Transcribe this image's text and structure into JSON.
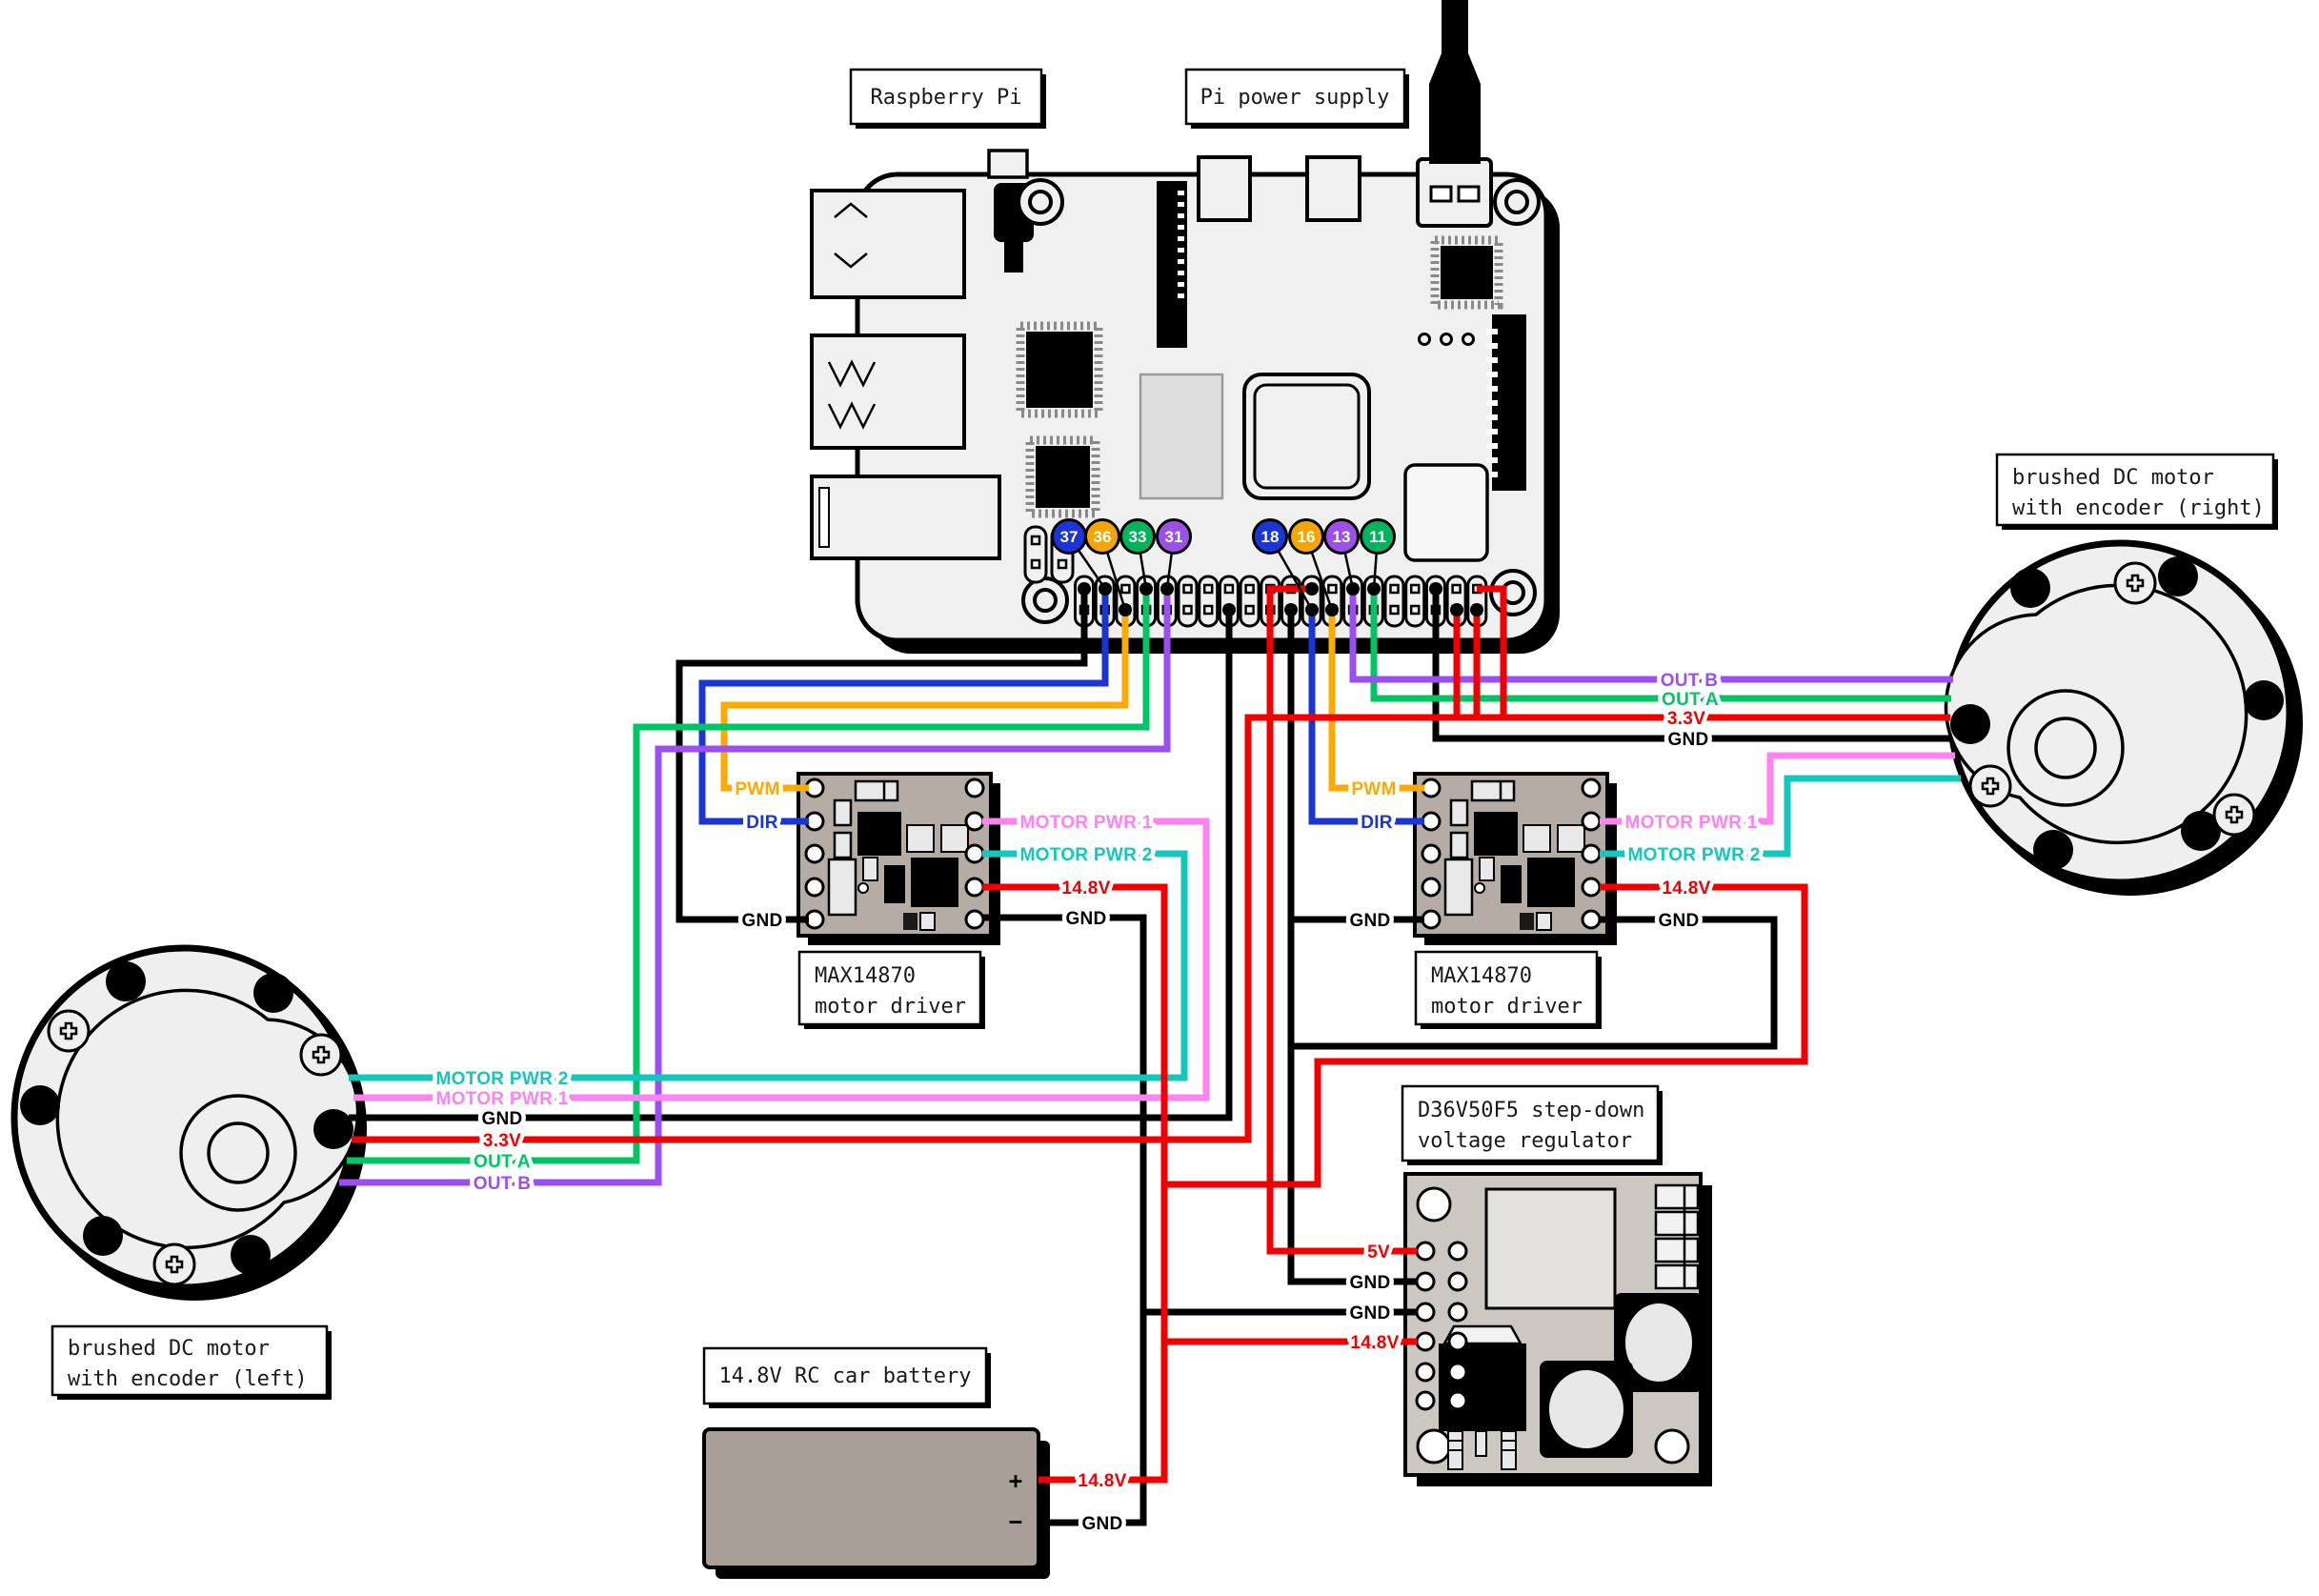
{
  "boxes": {
    "raspberry_pi": "Raspberry Pi",
    "pi_power_supply": "Pi power supply",
    "motor_driver_line1": "MAX14870",
    "motor_driver_line2": "motor driver",
    "regulator_line1": "D36V50F5 step-down",
    "regulator_line2": "voltage regulator",
    "battery": "14.8V RC car battery",
    "motor_left_line1": "brushed DC motor",
    "motor_left_line2": "with encoder (left)",
    "motor_right_line1": "brushed DC motor",
    "motor_right_line2": "with encoder (right)"
  },
  "wire_labels": {
    "pwm": "PWM",
    "dir": "DIR",
    "gnd": "GND",
    "motor_pwr_1": "MOTOR PWR 1",
    "motor_pwr_2": "MOTOR PWR 2",
    "v_14_8": "14.8V",
    "v_3_3": "3.3V",
    "v_5": "5V",
    "out_a": "OUT A",
    "out_b": "OUT B",
    "plus": "+",
    "minus": "−"
  },
  "gpio_pins": [
    {
      "number": "37",
      "color": "#1b35d6"
    },
    {
      "number": "36",
      "color": "#f5a500"
    },
    {
      "number": "33",
      "color": "#00b35c"
    },
    {
      "number": "31",
      "color": "#9b51e8"
    },
    {
      "number": "18",
      "color": "#1b35d6"
    },
    {
      "number": "16",
      "color": "#f5a500"
    },
    {
      "number": "13",
      "color": "#9b51e8"
    },
    {
      "number": "11",
      "color": "#00b35c"
    }
  ],
  "colors": {
    "black": "#000000",
    "red": "#f20000",
    "orange": "#ffaa00",
    "blue": "#1a35d3",
    "green": "#00c566",
    "purple": "#9b4ff0",
    "pink": "#ff82f1",
    "cyan": "#14c7bc",
    "pi_board": "#f0f0f0",
    "driver_pcb": "#b5ada5",
    "regulator_pcb": "#ccc7c1",
    "battery_body": "#a89f97"
  },
  "connections": [
    {
      "signal": "PWM",
      "from": "Raspberry Pi pin 36",
      "to": "MAX14870 motor driver (left) PWM",
      "color": "orange"
    },
    {
      "signal": "DIR",
      "from": "Raspberry Pi pin 37",
      "to": "MAX14870 motor driver (left) DIR",
      "color": "blue"
    },
    {
      "signal": "GND",
      "from": "Raspberry Pi GND",
      "to": "MAX14870 motor driver (left) GND",
      "color": "black"
    },
    {
      "signal": "MOTOR PWR 1",
      "from": "MAX14870 (left)",
      "to": "brushed DC motor (left)",
      "color": "pink"
    },
    {
      "signal": "MOTOR PWR 2",
      "from": "MAX14870 (left)",
      "to": "brushed DC motor (left)",
      "color": "cyan"
    },
    {
      "signal": "OUT A",
      "from": "Raspberry Pi pin 33",
      "to": "left motor encoder OUT A",
      "color": "green"
    },
    {
      "signal": "OUT B",
      "from": "Raspberry Pi pin 31",
      "to": "left motor encoder OUT B",
      "color": "purple"
    },
    {
      "signal": "3.3V",
      "from": "Raspberry Pi 3.3V",
      "to": "left and right motor encoders",
      "color": "red"
    },
    {
      "signal": "GND",
      "from": "Raspberry Pi GND",
      "to": "left motor encoder GND",
      "color": "black"
    },
    {
      "signal": "PWM",
      "from": "Raspberry Pi pin 16",
      "to": "MAX14870 motor driver (right) PWM",
      "color": "orange"
    },
    {
      "signal": "DIR",
      "from": "Raspberry Pi pin 18",
      "to": "MAX14870 motor driver (right) DIR",
      "color": "blue"
    },
    {
      "signal": "OUT B",
      "from": "Raspberry Pi pin 13",
      "to": "right motor encoder OUT B",
      "color": "purple"
    },
    {
      "signal": "OUT A",
      "from": "Raspberry Pi pin 11",
      "to": "right motor encoder OUT A",
      "color": "green"
    },
    {
      "signal": "GND",
      "from": "Raspberry Pi GND",
      "to": "right motor encoder GND",
      "color": "black"
    },
    {
      "signal": "MOTOR PWR 1",
      "from": "MAX14870 (right)",
      "to": "brushed DC motor (right)",
      "color": "pink"
    },
    {
      "signal": "MOTOR PWR 2",
      "from": "MAX14870 (right)",
      "to": "brushed DC motor (right)",
      "color": "cyan"
    },
    {
      "signal": "14.8V",
      "from": "14.8V RC car battery +",
      "to": "both MAX14870 drivers and D36V50F5 regulator",
      "color": "red"
    },
    {
      "signal": "GND",
      "from": "14.8V RC car battery −",
      "to": "drivers and D36V50F5 regulator GND",
      "color": "black"
    },
    {
      "signal": "5V",
      "from": "D36V50F5 regulator 5V",
      "to": "Raspberry Pi 5V",
      "color": "red"
    },
    {
      "signal": "power",
      "from": "Pi power supply",
      "to": "Raspberry Pi USB-C",
      "color": "black"
    }
  ]
}
